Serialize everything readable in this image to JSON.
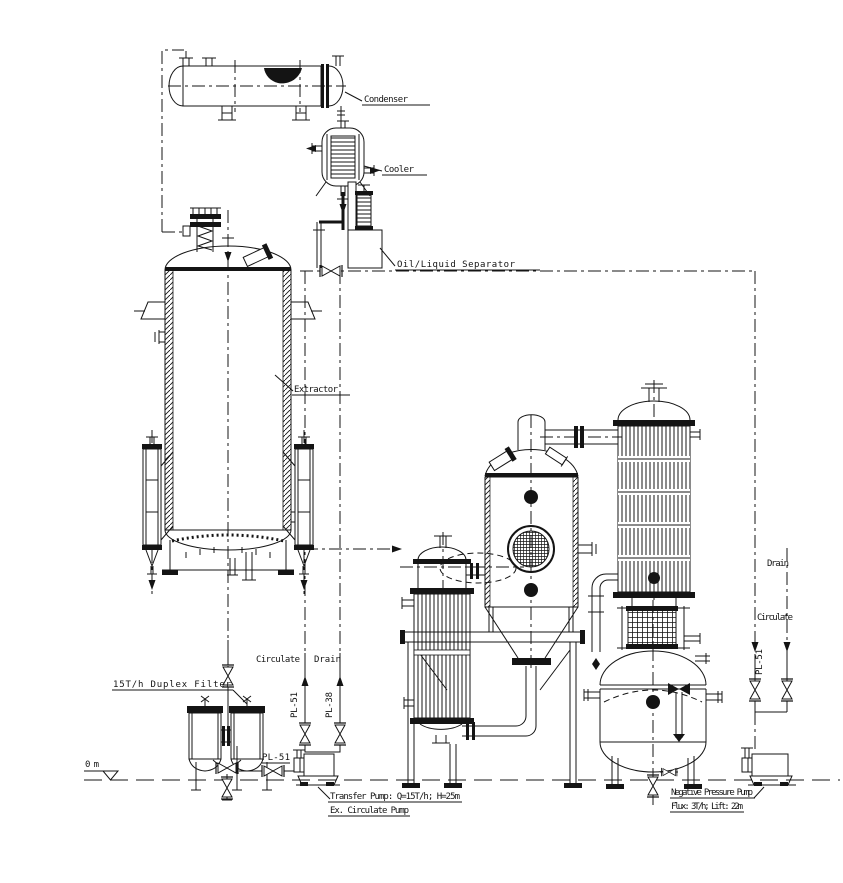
{
  "diagram": {
    "kind": "process-equipment-elevation-drawing",
    "colors": {
      "line": "#141414",
      "background": "#ffffff"
    },
    "equipment": {
      "condenser": {
        "label": "Condenser"
      },
      "cooler": {
        "label": "Cooler"
      },
      "oil_liquid_separator": {
        "label": "Oil/Liquid Separator"
      },
      "extractor": {
        "label": "Extractor"
      },
      "duplex_filter": {
        "label": "15T/h Duplex Filter"
      },
      "transfer_pump": {
        "label": "Transfer Pump: Q=15T/h; H=25m",
        "alt_label": "Ex. Circulate Pump"
      },
      "negative_pressure_pump": {
        "label": "Negative Pressure Pump",
        "spec": "Flux: 3T/h; Lift: 22m"
      }
    },
    "lines": {
      "mid": {
        "circulate": "Circulate",
        "drain": "Drain",
        "pl51": "PL-51",
        "pl38": "PL-38"
      },
      "pump_suction": {
        "pl51": "PL-51"
      },
      "right": {
        "drain": "Drain",
        "circulate": "Circulate",
        "pl51": "PL-51"
      }
    },
    "datum": {
      "ground": "0m"
    }
  }
}
